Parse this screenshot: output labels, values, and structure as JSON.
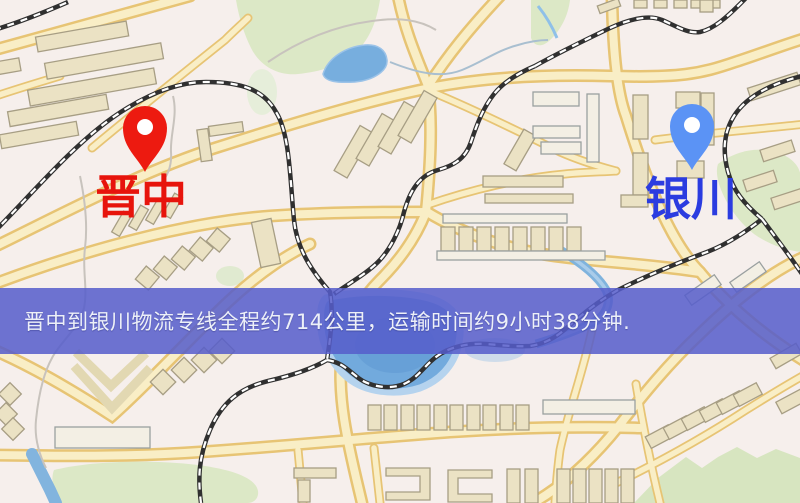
{
  "map": {
    "origin": {
      "name": "晋中"
    },
    "destination": {
      "name": "银川"
    },
    "banner": {
      "text": "晋中到银川物流专线全程约714公里，运输时间约9小时38分钟.",
      "distance_text": "约714公里",
      "duration_text": "约9小时38分钟"
    },
    "colors": {
      "origin_pin": "#ed1a10",
      "origin_label": "#e7140c",
      "destination_pin": "#5b93f5",
      "destination_label": "#2b3ce0",
      "banner_bg": "rgba(86,93,203,0.86)",
      "banner_text": "#edf0f8",
      "road_fill": "#f9eec6",
      "road_casing": "#e7c474",
      "water": "#72aadd",
      "park": "#dce8c6",
      "building": "#ebe2c4",
      "railway": "#303030",
      "background": "#f6efec"
    }
  }
}
